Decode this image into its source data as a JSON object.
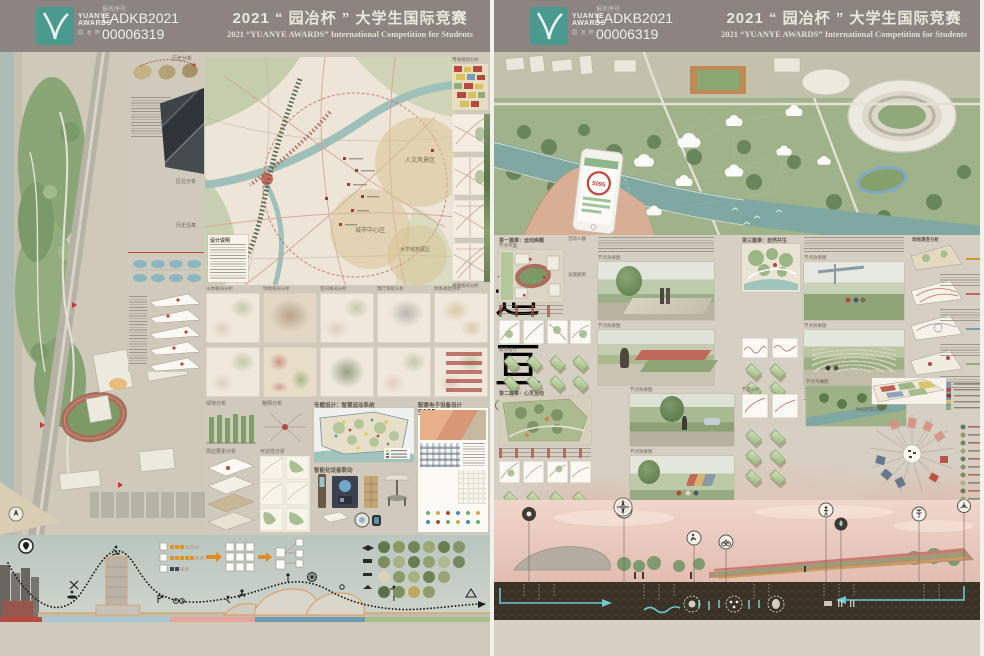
{
  "header": {
    "reg_label": "报名序号:",
    "reg_no1": "LADKB2021",
    "reg_no2": "00006319",
    "title_cn": "2021 “ 园冶杯 ” 大学生国际竞赛",
    "title_en": "2021 “YUANYE AWARDS” International Competition for  Students",
    "logo_name1": "YUANYE",
    "logo_name2": "AWARDS",
    "logo_sub": "园 冶 杯"
  },
  "calligraphy": {
    "char1": "追",
    "char2": "亘"
  },
  "left": {
    "number": "①",
    "map_zones": {
      "z1": "人文风景区",
      "z2": "城市中心区",
      "z3": "大学城拓展区"
    },
    "grid_titles": [
      "山体格局分析",
      "场地格局分析",
      "空间格局分析",
      "慢行系统分析",
      "体系规划分析"
    ],
    "labels": {
      "history": "历史分析",
      "location": "区位分析",
      "evolution": "历史沿革",
      "design_note": "设计说明",
      "green": "绿地分析",
      "roadnet": "路网分析",
      "context": "周边要素分析",
      "access": "可达性分析",
      "smart": "专题设计：智慧运动系统",
      "devices": "智能化设备联动",
      "electronics": "配套电子设备设计",
      "landuse": "用地规划分析",
      "roadgrid": "路网格局分析"
    },
    "device_value": "5095"
  },
  "right": {
    "number": "②",
    "phone_value": "5095",
    "chapters": [
      "第一篇章：运动唤醒",
      "第二篇章：心灵互动",
      "第三篇章：自然共生"
    ],
    "labels": {
      "node_plan": "节点平面",
      "node_render": "节点效果图",
      "node_analysis": "节点分析",
      "module": "模块设计",
      "crowd": "活动人群",
      "facility": "设施图例",
      "phases": "场地演变分析",
      "planting": "种植配置分析",
      "aerial": "节点鸟瞰图"
    }
  },
  "colors": {
    "accent_teal": "#4a9a8f",
    "header_gray": "#8b8480",
    "board_bg": "#d0cabd",
    "water": "#8fb3ae",
    "soil": "#3a3127",
    "pipe_cyan": "#6cc8d6",
    "seal_red": "#a5372e",
    "orange_outline": "#dfa068"
  }
}
